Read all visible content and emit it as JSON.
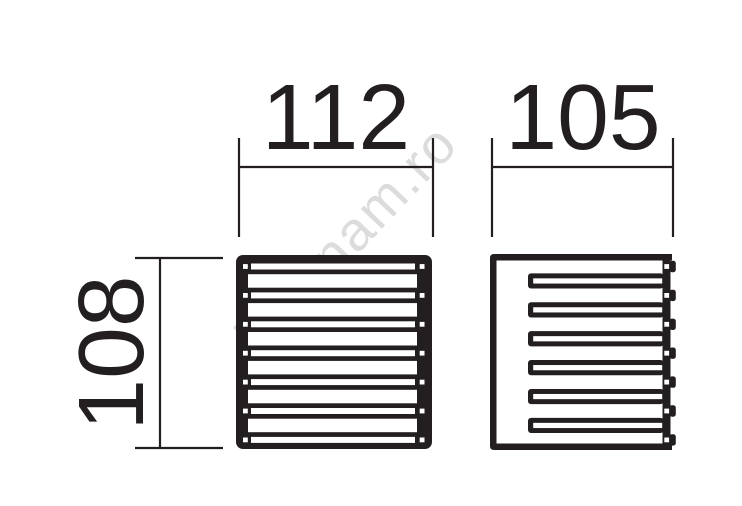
{
  "page": {
    "background": "#ffffff"
  },
  "drawing": {
    "title": "louvered-square-wall-light-dimension-drawing",
    "ink_color": "#231f20",
    "dimensions": {
      "front_width": {
        "value": "112",
        "orientation": "horizontal",
        "applies_to": "front-view"
      },
      "side_width": {
        "value": "105",
        "orientation": "horizontal",
        "applies_to": "side-view"
      },
      "front_height": {
        "value": "108",
        "orientation": "vertical",
        "applies_to": "front-view"
      }
    },
    "views": {
      "front": {
        "slot_rows": 7,
        "holes_per_row": 2,
        "light_bands": 6
      },
      "side": {
        "louvers": 6,
        "rail_holes": 7
      }
    }
  },
  "watermark": {
    "text": "luminam.ro",
    "color": "#dcdcdc"
  }
}
